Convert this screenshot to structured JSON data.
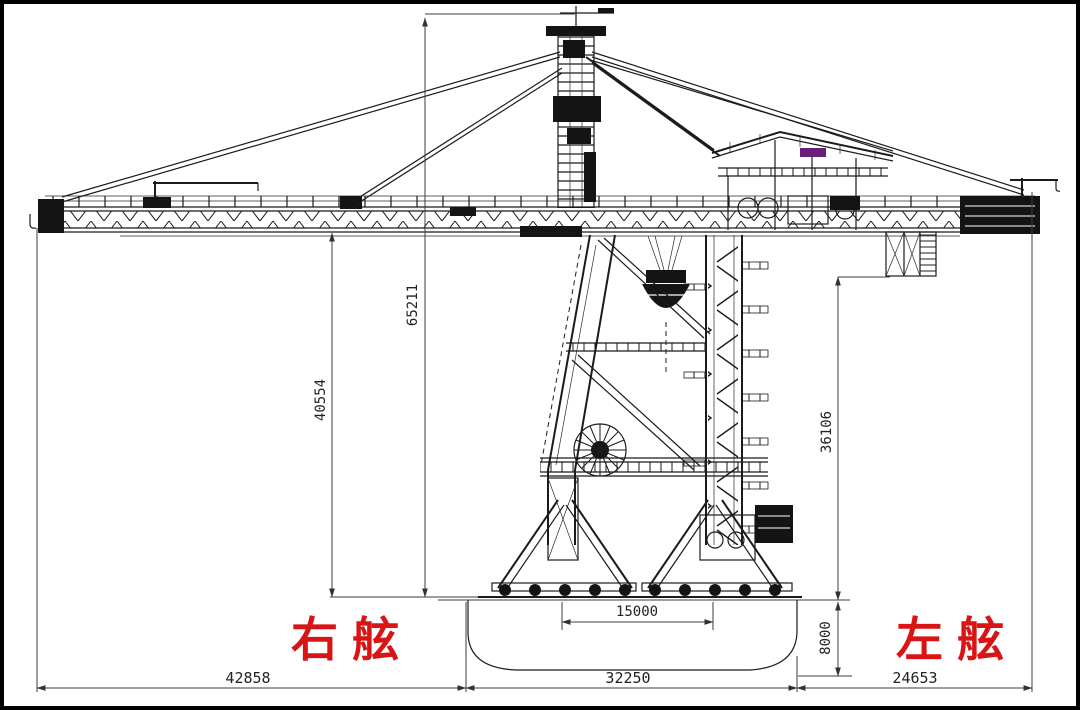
{
  "labels": {
    "starboard": "右舷",
    "port": "左舷"
  },
  "dimensions": {
    "total_height": "65211",
    "tower_height": "40554",
    "counterjib_height": "36106",
    "leg_span": "15000",
    "hull_depth": "8000",
    "left_span": "42858",
    "center_span": "32250",
    "right_span": "24653"
  },
  "colors": {
    "label_red": "#d81414",
    "line": "#1b1b1b",
    "accent_purple": "#6b1f7c"
  }
}
